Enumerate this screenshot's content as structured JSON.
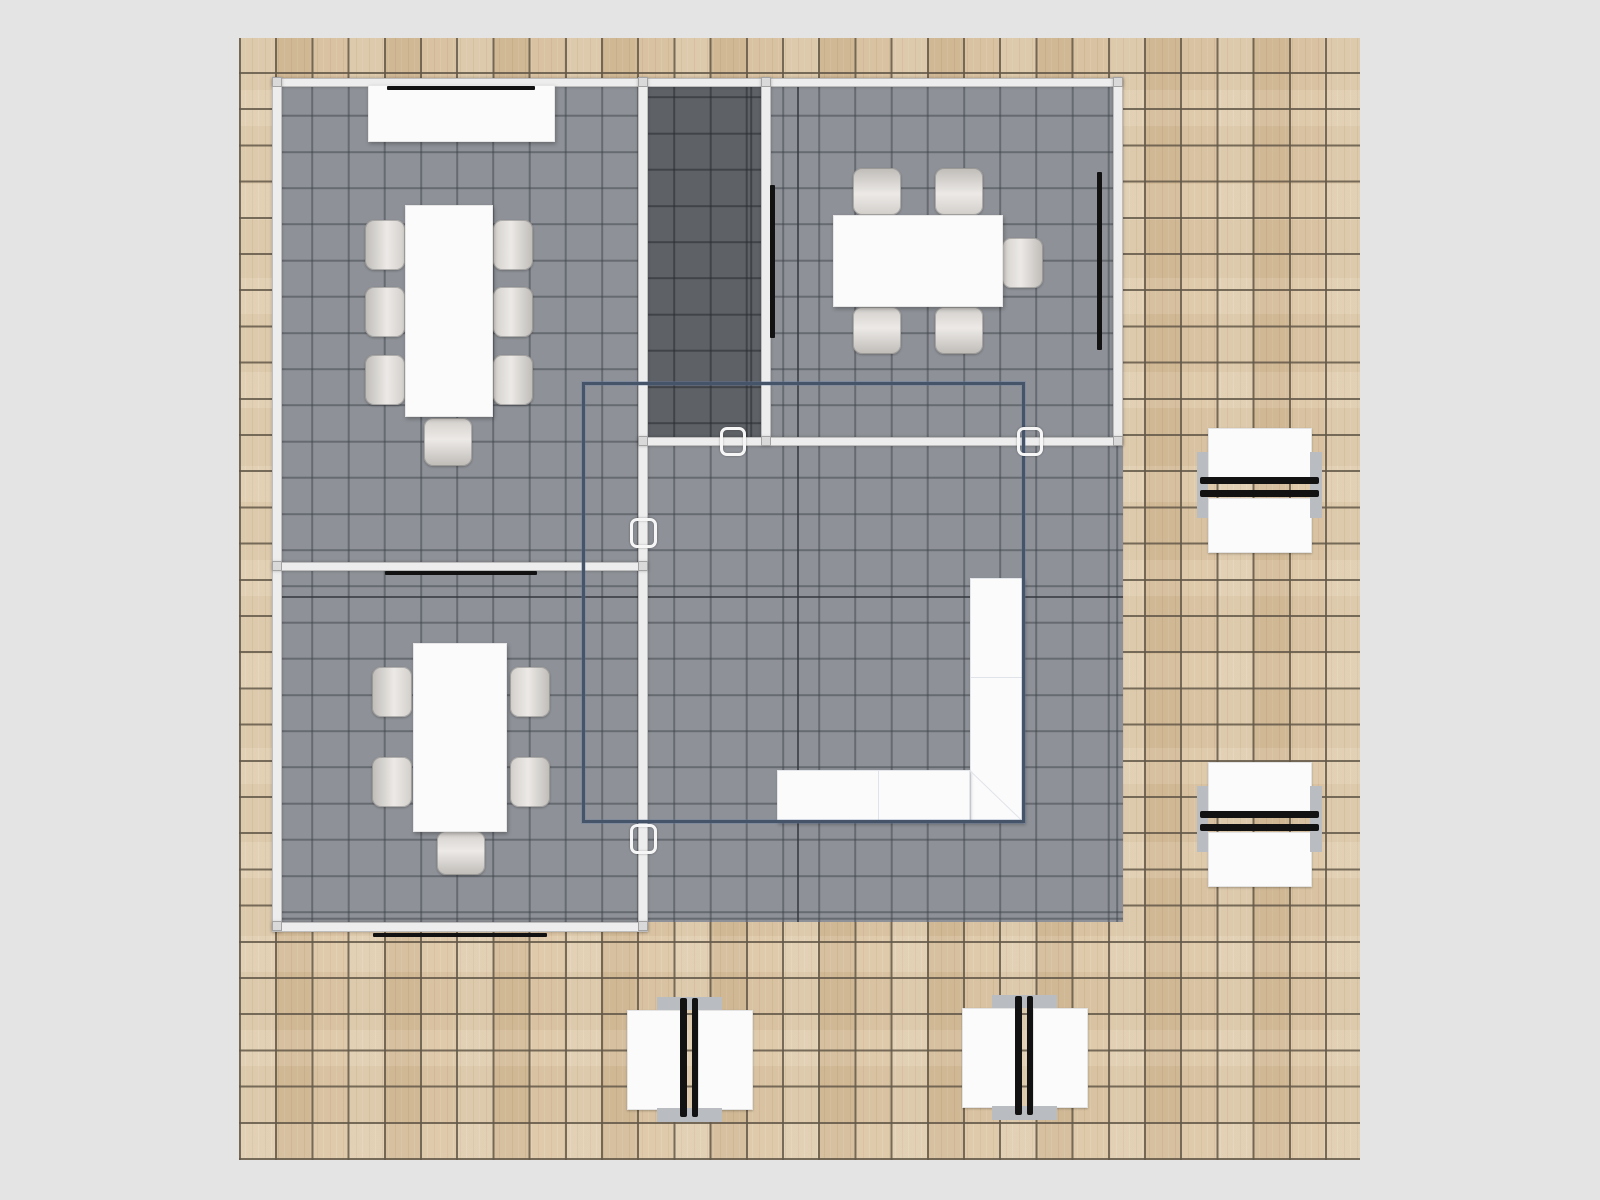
{
  "meta": {
    "app": "floor-plan-view",
    "description": "Top-down 3D floor plan of a booth/office: wood tile floor, gray carpeted rooms with conference furniture, wall screens, L-shaped counter, overhead structure outline, four double workstations",
    "stage": {
      "w": 1600,
      "h": 1200
    }
  },
  "colors": {
    "bg": "#e4e4e4",
    "wood": "#dcc6a4",
    "wood_line": "rgba(99,88,72,0.85)",
    "carpet": "#8e9298",
    "carpet_line": "rgba(63,67,74,0.5)",
    "dark": "#5e6267",
    "dark_line": "rgba(40,43,47,0.55)",
    "wall": "#ededed",
    "overlay": "#46546a",
    "tv": "#121212",
    "white": "#fbfbfb",
    "panel": "#b9bcc0"
  },
  "grid": {
    "tile": 36.2,
    "origin_x": 239,
    "origin_y": 38
  },
  "items": [
    {
      "t": "wood",
      "n": "wood-floor",
      "i": "false",
      "x": 239,
      "y": 38,
      "w": 1121,
      "h": 1122
    },
    {
      "t": "carpet",
      "n": "booth-carpet",
      "i": "false",
      "x": 282,
      "y": 83,
      "w": 841,
      "h": 839
    },
    {
      "t": "darkroom",
      "n": "storage-room-floor",
      "i": "false",
      "x": 648,
      "y": 87,
      "w": 113,
      "h": 350
    },
    {
      "t": "line",
      "n": "carpet-major-line-vertical",
      "i": "false",
      "x": 797,
      "y": 87,
      "w": 2,
      "h": 835
    },
    {
      "t": "line",
      "n": "carpet-major-line-horizontal",
      "i": "false",
      "x": 282,
      "y": 596,
      "w": 841,
      "h": 2
    },
    {
      "t": "wall",
      "n": "wall-top",
      "i": "true",
      "x": 272,
      "y": 78,
      "w": 851,
      "h": 9
    },
    {
      "t": "wall",
      "n": "wall-left",
      "i": "true",
      "x": 272,
      "y": 78,
      "w": 10,
      "h": 854
    },
    {
      "t": "wall",
      "n": "wall-center-vertical",
      "i": "true",
      "x": 638,
      "y": 78,
      "w": 10,
      "h": 854
    },
    {
      "t": "wall",
      "n": "wall-storage-right",
      "i": "true",
      "x": 761,
      "y": 78,
      "w": 10,
      "h": 368
    },
    {
      "t": "wall",
      "n": "wall-right",
      "i": "true",
      "x": 1113,
      "y": 78,
      "w": 10,
      "h": 368
    },
    {
      "t": "wall",
      "n": "wall-mid-horizontal",
      "i": "true",
      "x": 638,
      "y": 437,
      "w": 485,
      "h": 9
    },
    {
      "t": "wall",
      "n": "wall-left-rooms-divider",
      "i": "true",
      "x": 272,
      "y": 562,
      "w": 376,
      "h": 9
    },
    {
      "t": "wall",
      "n": "wall-bottom-left",
      "i": "true",
      "x": 272,
      "y": 922,
      "w": 376,
      "h": 10
    },
    {
      "t": "post",
      "n": "wall-connector-post",
      "i": "false",
      "x": 272,
      "y": 77,
      "w": 10,
      "h": 10
    },
    {
      "t": "post",
      "n": "wall-connector-post",
      "i": "false",
      "x": 638,
      "y": 77,
      "w": 10,
      "h": 10
    },
    {
      "t": "post",
      "n": "wall-connector-post",
      "i": "false",
      "x": 761,
      "y": 77,
      "w": 10,
      "h": 10
    },
    {
      "t": "post",
      "n": "wall-connector-post",
      "i": "false",
      "x": 1113,
      "y": 77,
      "w": 10,
      "h": 10
    },
    {
      "t": "post",
      "n": "wall-connector-post",
      "i": "false",
      "x": 272,
      "y": 561,
      "w": 10,
      "h": 10
    },
    {
      "t": "post",
      "n": "wall-connector-post",
      "i": "false",
      "x": 638,
      "y": 561,
      "w": 10,
      "h": 10
    },
    {
      "t": "post",
      "n": "wall-connector-post",
      "i": "false",
      "x": 272,
      "y": 921,
      "w": 10,
      "h": 10
    },
    {
      "t": "post",
      "n": "wall-connector-post",
      "i": "false",
      "x": 638,
      "y": 921,
      "w": 10,
      "h": 10
    },
    {
      "t": "post",
      "n": "wall-connector-post",
      "i": "false",
      "x": 638,
      "y": 436,
      "w": 10,
      "h": 10
    },
    {
      "t": "post",
      "n": "wall-connector-post",
      "i": "false",
      "x": 761,
      "y": 436,
      "w": 10,
      "h": 10
    },
    {
      "t": "post",
      "n": "wall-connector-post",
      "i": "false",
      "x": 1113,
      "y": 436,
      "w": 10,
      "h": 10
    },
    {
      "t": "chair",
      "n": "chair",
      "i": "true",
      "o": "l",
      "x": 365,
      "y": 220,
      "w": 40,
      "h": 50
    },
    {
      "t": "chair",
      "n": "chair",
      "i": "true",
      "o": "l",
      "x": 365,
      "y": 287,
      "w": 40,
      "h": 50
    },
    {
      "t": "chair",
      "n": "chair",
      "i": "true",
      "o": "l",
      "x": 365,
      "y": 355,
      "w": 40,
      "h": 50
    },
    {
      "t": "chair",
      "n": "chair",
      "i": "true",
      "o": "r",
      "x": 493,
      "y": 220,
      "w": 40,
      "h": 50
    },
    {
      "t": "chair",
      "n": "chair",
      "i": "true",
      "o": "r",
      "x": 493,
      "y": 287,
      "w": 40,
      "h": 50
    },
    {
      "t": "chair",
      "n": "chair",
      "i": "true",
      "o": "r",
      "x": 493,
      "y": 355,
      "w": 40,
      "h": 50
    },
    {
      "t": "chair",
      "n": "chair",
      "i": "true",
      "o": "b",
      "x": 424,
      "y": 418,
      "w": 48,
      "h": 48
    },
    {
      "t": "chair",
      "n": "chair",
      "i": "true",
      "o": "t",
      "x": 853,
      "y": 168,
      "w": 48,
      "h": 47
    },
    {
      "t": "chair",
      "n": "chair",
      "i": "true",
      "o": "t",
      "x": 935,
      "y": 168,
      "w": 48,
      "h": 47
    },
    {
      "t": "chair",
      "n": "chair",
      "i": "true",
      "o": "b",
      "x": 853,
      "y": 307,
      "w": 48,
      "h": 47
    },
    {
      "t": "chair",
      "n": "chair",
      "i": "true",
      "o": "b",
      "x": 935,
      "y": 307,
      "w": 48,
      "h": 47
    },
    {
      "t": "chair",
      "n": "chair",
      "i": "true",
      "o": "r",
      "x": 1002,
      "y": 238,
      "w": 41,
      "h": 50
    },
    {
      "t": "chair",
      "n": "chair",
      "i": "true",
      "o": "l",
      "x": 372,
      "y": 667,
      "w": 40,
      "h": 50
    },
    {
      "t": "chair",
      "n": "chair",
      "i": "true",
      "o": "l",
      "x": 372,
      "y": 757,
      "w": 40,
      "h": 50
    },
    {
      "t": "chair",
      "n": "chair",
      "i": "true",
      "o": "r",
      "x": 510,
      "y": 667,
      "w": 40,
      "h": 50
    },
    {
      "t": "chair",
      "n": "chair",
      "i": "true",
      "o": "r",
      "x": 510,
      "y": 757,
      "w": 40,
      "h": 50
    },
    {
      "t": "chair",
      "n": "chair",
      "i": "true",
      "o": "b",
      "x": 437,
      "y": 831,
      "w": 48,
      "h": 44
    },
    {
      "t": "cabinet",
      "n": "credenza",
      "i": "true",
      "x": 368,
      "y": 85,
      "w": 187,
      "h": 57
    },
    {
      "t": "table",
      "n": "conference-table",
      "i": "true",
      "x": 405,
      "y": 205,
      "w": 88,
      "h": 212
    },
    {
      "t": "table",
      "n": "meeting-table",
      "i": "true",
      "x": 833,
      "y": 215,
      "w": 170,
      "h": 92
    },
    {
      "t": "table",
      "n": "team-table",
      "i": "true",
      "x": 413,
      "y": 643,
      "w": 94,
      "h": 189
    },
    {
      "t": "counter",
      "n": "reception-counter-vertical",
      "i": "true",
      "x": 970,
      "y": 578,
      "w": 55,
      "h": 245
    },
    {
      "t": "counter",
      "n": "reception-counter-horizontal",
      "i": "true",
      "x": 777,
      "y": 770,
      "w": 193,
      "h": 53
    },
    {
      "t": "seam",
      "n": "counter-seam",
      "i": "false",
      "x": 970,
      "y": 677,
      "w": 55,
      "h": 1
    },
    {
      "t": "seam",
      "n": "counter-seam",
      "i": "false",
      "x": 878,
      "y": 770,
      "w": 1,
      "h": 53
    },
    {
      "t": "seam",
      "n": "counter-seam",
      "i": "false",
      "x": 970,
      "y": 770,
      "w": 76,
      "h": 1,
      "a": 43.9
    },
    {
      "t": "tv",
      "n": "screen-conference-room-top",
      "i": "true",
      "x": 387,
      "y": 86,
      "w": 148,
      "h": 4
    },
    {
      "t": "tv",
      "n": "screen-team-room-top",
      "i": "true",
      "x": 385,
      "y": 571,
      "w": 152,
      "h": 4
    },
    {
      "t": "tv",
      "n": "screen-outside-bottom",
      "i": "true",
      "x": 373,
      "y": 933,
      "w": 174,
      "h": 4
    },
    {
      "t": "tv",
      "n": "screen-meeting-room-left",
      "i": "true",
      "x": 770,
      "y": 185,
      "w": 5,
      "h": 153
    },
    {
      "t": "tv",
      "n": "screen-meeting-room-right",
      "i": "true",
      "x": 1097,
      "y": 172,
      "w": 5,
      "h": 178
    },
    {
      "t": "overlay",
      "n": "overhead-structure-outline",
      "i": "true",
      "x": 582,
      "y": 382,
      "w": 443,
      "h": 441
    },
    {
      "t": "clamp",
      "n": "door-connector",
      "i": "true",
      "x": 630,
      "y": 518,
      "w": 27,
      "h": 30
    },
    {
      "t": "clamp",
      "n": "door-connector",
      "i": "true",
      "x": 630,
      "y": 824,
      "w": 27,
      "h": 30
    },
    {
      "t": "clamp",
      "n": "door-connector",
      "i": "true",
      "x": 720,
      "y": 427,
      "w": 26,
      "h": 29
    },
    {
      "t": "clamp",
      "n": "door-connector",
      "i": "true",
      "x": 1017,
      "y": 427,
      "w": 26,
      "h": 29
    },
    {
      "t": "ws",
      "n": "workstation-right-upper",
      "i": "true",
      "o": "h",
      "x": 1196,
      "y": 427,
      "w": 126,
      "h": 124
    },
    {
      "t": "ws",
      "n": "workstation-right-lower",
      "i": "true",
      "o": "h",
      "x": 1196,
      "y": 761,
      "w": 126,
      "h": 124
    },
    {
      "t": "ws",
      "n": "workstation-bottom-left",
      "i": "true",
      "o": "v",
      "x": 626,
      "y": 996,
      "w": 125,
      "h": 126
    },
    {
      "t": "ws",
      "n": "workstation-bottom-right",
      "i": "true",
      "o": "v",
      "x": 961,
      "y": 994,
      "w": 125,
      "h": 126
    }
  ],
  "workstation_layout": {
    "h": {
      "desks": [
        [
          12,
          1,
          102,
          49
        ],
        [
          12,
          71,
          102,
          53
        ]
      ],
      "panels": [
        [
          1,
          25,
          11,
          66
        ],
        [
          114,
          25,
          12,
          66
        ]
      ],
      "bars": [
        [
          4,
          50,
          119,
          7
        ],
        [
          4,
          63,
          119,
          7
        ]
      ]
    },
    "v": {
      "desks": [
        [
          1,
          14,
          53,
          98
        ],
        [
          72,
          14,
          53,
          98
        ]
      ],
      "panels": [
        [
          31,
          1,
          65,
          13
        ],
        [
          31,
          112,
          65,
          14
        ]
      ],
      "bars": [
        [
          54,
          2,
          7,
          119
        ],
        [
          66,
          2,
          6,
          119
        ]
      ]
    }
  }
}
